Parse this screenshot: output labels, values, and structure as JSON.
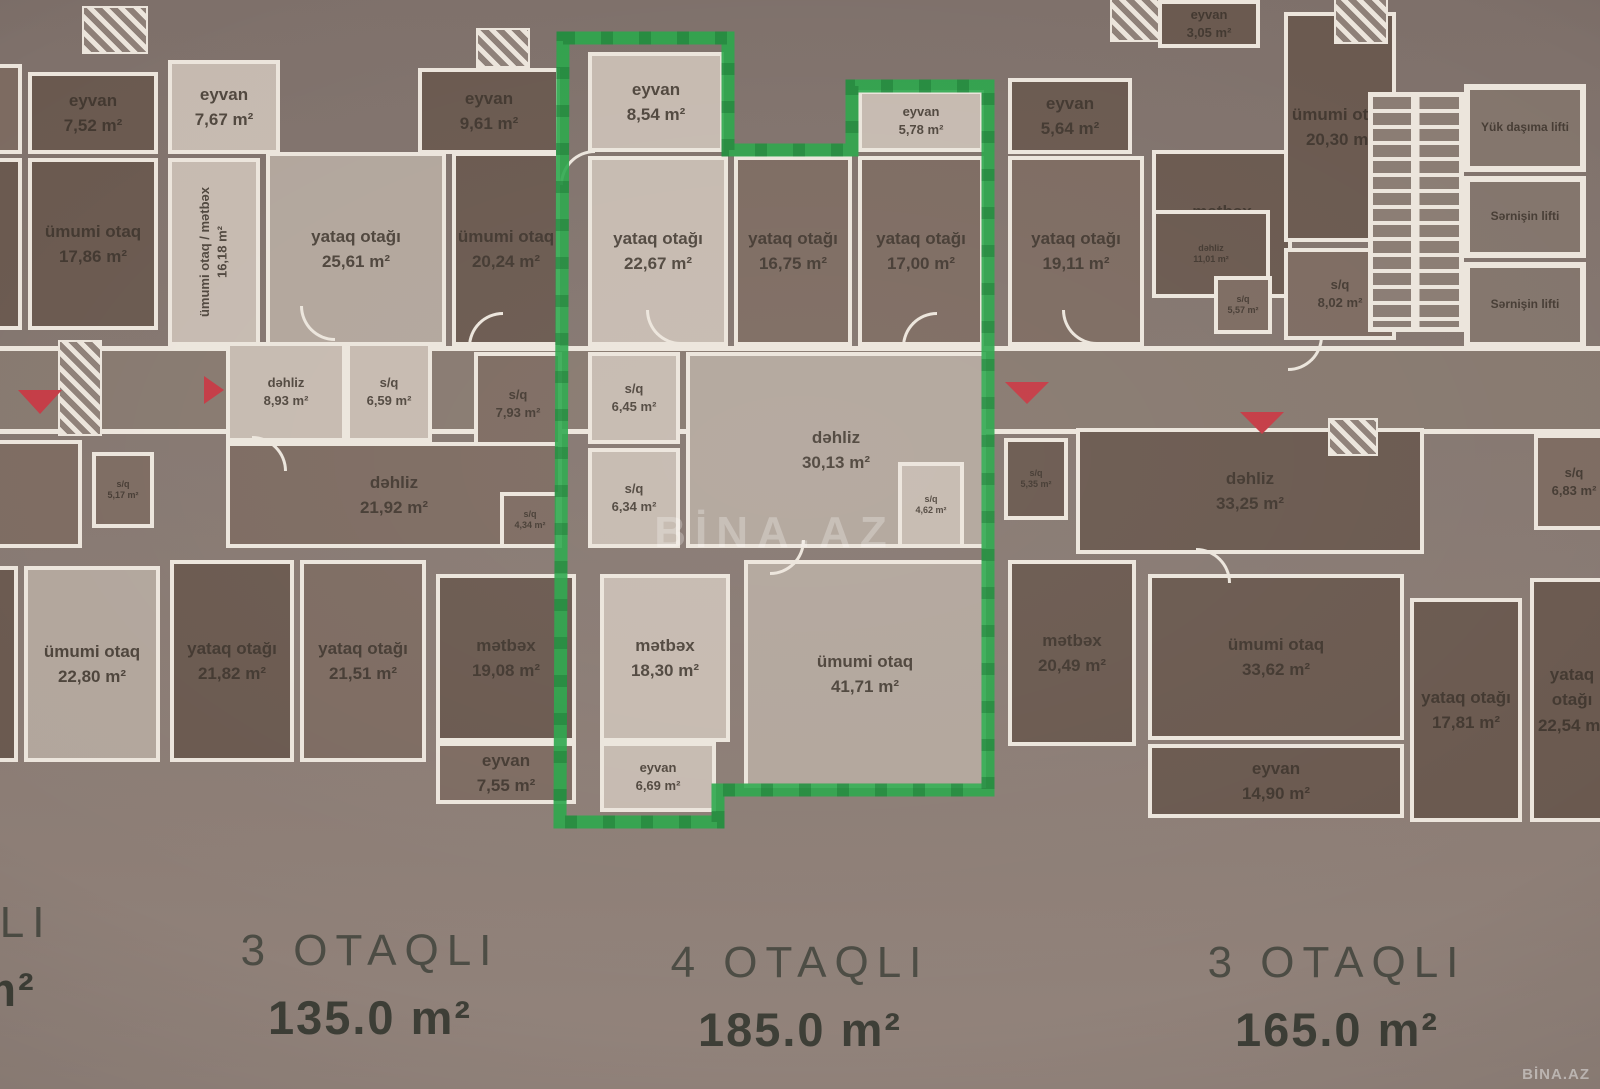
{
  "plan": {
    "rooms": [
      {
        "label": "",
        "area": "",
        "x": -36,
        "y": 64,
        "w": 58,
        "h": 90,
        "tone": "med"
      },
      {
        "label": "",
        "area": "",
        "x": -36,
        "y": 158,
        "w": 58,
        "h": 172,
        "tone": "dark"
      },
      {
        "label": "",
        "area": "",
        "x": -36,
        "y": 440,
        "w": 118,
        "h": 108,
        "tone": "med"
      },
      {
        "label": "",
        "area": "",
        "x": -36,
        "y": 566,
        "w": 54,
        "h": 196,
        "tone": "dark"
      },
      {
        "label": "eyvan",
        "area": "7,52 m²",
        "x": 28,
        "y": 72,
        "w": 130,
        "h": 82,
        "tone": "dark"
      },
      {
        "label": "eyvan",
        "area": "7,67 m²",
        "x": 168,
        "y": 60,
        "w": 112,
        "h": 94,
        "tone": "light"
      },
      {
        "label": "eyvan",
        "area": "9,61 m²",
        "x": 418,
        "y": 68,
        "w": 142,
        "h": 86,
        "tone": "dark"
      },
      {
        "label": "eyvan",
        "area": "8,54 m²",
        "x": 588,
        "y": 52,
        "w": 136,
        "h": 100,
        "tone": "light"
      },
      {
        "label": "eyvan",
        "area": "5,78 m²",
        "x": 858,
        "y": 90,
        "w": 126,
        "h": 62,
        "tone": "light",
        "size": "small"
      },
      {
        "label": "eyvan",
        "area": "5,64 m²",
        "x": 1008,
        "y": 78,
        "w": 124,
        "h": 76,
        "tone": "dark"
      },
      {
        "label": "eyvan",
        "area": "3,05 m²",
        "x": 1158,
        "y": 0,
        "w": 102,
        "h": 48,
        "tone": "dark",
        "size": "small"
      },
      {
        "label": "ümumi otaq",
        "area": "17,86 m²",
        "x": 28,
        "y": 158,
        "w": 130,
        "h": 172,
        "tone": "dark"
      },
      {
        "label": "ümumi otaq / mətbəx",
        "area": "16,18 m²",
        "x": 168,
        "y": 158,
        "w": 92,
        "h": 188,
        "tone": "light",
        "rot": true,
        "size": "small"
      },
      {
        "label": "yataq otağı",
        "area": "25,61 m²",
        "x": 266,
        "y": 152,
        "w": 180,
        "h": 194,
        "tone": "lighter"
      },
      {
        "label": "ümumi otaq",
        "area": "20,24 m²",
        "x": 452,
        "y": 152,
        "w": 108,
        "h": 194,
        "tone": "dark"
      },
      {
        "label": "yataq otağı",
        "area": "22,67 m²",
        "x": 588,
        "y": 156,
        "w": 140,
        "h": 190,
        "tone": "light"
      },
      {
        "label": "yataq otağı",
        "area": "16,75 m²",
        "x": 734,
        "y": 156,
        "w": 118,
        "h": 190,
        "tone": "med"
      },
      {
        "label": "yataq otağı",
        "area": "17,00 m²",
        "x": 858,
        "y": 156,
        "w": 126,
        "h": 190,
        "tone": "med"
      },
      {
        "label": "yataq otağı",
        "area": "19,11 m²",
        "x": 1008,
        "y": 156,
        "w": 136,
        "h": 190,
        "tone": "med"
      },
      {
        "label": "mətbəx",
        "area": "13,05 m²",
        "x": 1152,
        "y": 150,
        "w": 140,
        "h": 148,
        "tone": "dark"
      },
      {
        "label": "ümumi otaq",
        "area": "20,30 m²",
        "x": 1284,
        "y": 12,
        "w": 112,
        "h": 230,
        "tone": "dark"
      },
      {
        "label": "dəhliz",
        "area": "11,01 m²",
        "x": 1152,
        "y": 210,
        "w": 118,
        "h": 88,
        "tone": "dark",
        "size": "tiny"
      },
      {
        "label": "s/q",
        "area": "5,57 m²",
        "x": 1214,
        "y": 276,
        "w": 58,
        "h": 58,
        "tone": "med",
        "size": "tiny"
      },
      {
        "label": "s/q",
        "area": "8,02 m²",
        "x": 1284,
        "y": 248,
        "w": 112,
        "h": 92,
        "tone": "med",
        "size": "small"
      },
      {
        "label": "dəhliz",
        "area": "8,93 m²",
        "x": 226,
        "y": 342,
        "w": 120,
        "h": 100,
        "tone": "light",
        "size": "small"
      },
      {
        "label": "s/q",
        "area": "6,59 m²",
        "x": 346,
        "y": 342,
        "w": 86,
        "h": 100,
        "tone": "light",
        "size": "small"
      },
      {
        "label": "s/q",
        "area": "7,93 m²",
        "x": 474,
        "y": 352,
        "w": 88,
        "h": 104,
        "tone": "med",
        "size": "small"
      },
      {
        "label": "s/q",
        "area": "5,17 m²",
        "x": 92,
        "y": 452,
        "w": 62,
        "h": 76,
        "tone": "med",
        "size": "tiny"
      },
      {
        "label": "dəhliz",
        "area": "21,92 m²",
        "x": 226,
        "y": 442,
        "w": 336,
        "h": 106,
        "tone": "med"
      },
      {
        "label": "s/q",
        "area": "4,34 m²",
        "x": 500,
        "y": 492,
        "w": 60,
        "h": 56,
        "tone": "med",
        "size": "tiny"
      },
      {
        "label": "s/q",
        "area": "6,45 m²",
        "x": 588,
        "y": 352,
        "w": 92,
        "h": 92,
        "tone": "light",
        "size": "small"
      },
      {
        "label": "s/q",
        "area": "6,34 m²",
        "x": 588,
        "y": 448,
        "w": 92,
        "h": 100,
        "tone": "light",
        "size": "small"
      },
      {
        "label": "dəhliz",
        "area": "30,13 m²",
        "x": 686,
        "y": 352,
        "w": 300,
        "h": 196,
        "tone": "lighter"
      },
      {
        "label": "s/q",
        "area": "4,62 m²",
        "x": 898,
        "y": 462,
        "w": 66,
        "h": 86,
        "tone": "light",
        "size": "tiny"
      },
      {
        "label": "s/q",
        "area": "5,35 m²",
        "x": 1004,
        "y": 438,
        "w": 64,
        "h": 82,
        "tone": "dark",
        "size": "tiny"
      },
      {
        "label": "dəhliz",
        "area": "33,25 m²",
        "x": 1076,
        "y": 428,
        "w": 348,
        "h": 126,
        "tone": "dark"
      },
      {
        "label": "s/q",
        "area": "6,83 m²",
        "x": 1534,
        "y": 434,
        "w": 80,
        "h": 96,
        "tone": "med",
        "size": "small"
      },
      {
        "label": "ümumi otaq",
        "area": "22,80 m²",
        "x": 24,
        "y": 566,
        "w": 136,
        "h": 196,
        "tone": "lighter"
      },
      {
        "label": "yataq otağı",
        "area": "21,82 m²",
        "x": 170,
        "y": 560,
        "w": 124,
        "h": 202,
        "tone": "dark"
      },
      {
        "label": "yataq otağı",
        "area": "21,51 m²",
        "x": 300,
        "y": 560,
        "w": 126,
        "h": 202,
        "tone": "med"
      },
      {
        "label": "mətbəx",
        "area": "19,08 m²",
        "x": 436,
        "y": 574,
        "w": 140,
        "h": 168,
        "tone": "dark"
      },
      {
        "label": "mətbəx",
        "area": "18,30 m²",
        "x": 600,
        "y": 574,
        "w": 130,
        "h": 168,
        "tone": "light"
      },
      {
        "label": "ümumi otaq",
        "area": "41,71 m²",
        "x": 744,
        "y": 560,
        "w": 242,
        "h": 228,
        "tone": "lighter"
      },
      {
        "label": "mətbəx",
        "area": "20,49 m²",
        "x": 1008,
        "y": 560,
        "w": 128,
        "h": 186,
        "tone": "dark"
      },
      {
        "label": "ümumi otaq",
        "area": "33,62 m²",
        "x": 1148,
        "y": 574,
        "w": 256,
        "h": 166,
        "tone": "dark"
      },
      {
        "label": "yataq otağı",
        "area": "17,81 m²",
        "x": 1410,
        "y": 598,
        "w": 112,
        "h": 224,
        "tone": "dark"
      },
      {
        "label": "yataq otağı",
        "area": "22,54 m²",
        "x": 1530,
        "y": 578,
        "w": 84,
        "h": 244,
        "tone": "dark"
      },
      {
        "label": "eyvan",
        "area": "7,55 m²",
        "x": 436,
        "y": 742,
        "w": 140,
        "h": 62,
        "tone": "med"
      },
      {
        "label": "eyvan",
        "area": "6,69 m²",
        "x": 600,
        "y": 742,
        "w": 116,
        "h": 70,
        "tone": "light",
        "size": "small"
      },
      {
        "label": "eyvan",
        "area": "14,90 m²",
        "x": 1148,
        "y": 744,
        "w": 256,
        "h": 74,
        "tone": "dark"
      },
      {
        "label": "Yük daşıma lifti",
        "area": "",
        "x": 1464,
        "y": 84,
        "w": 122,
        "h": 88,
        "tone": "lift"
      },
      {
        "label": "Sərnişin lifti",
        "area": "",
        "x": 1464,
        "y": 176,
        "w": 122,
        "h": 82,
        "tone": "lift"
      },
      {
        "label": "Sərnişin lifti",
        "area": "",
        "x": 1464,
        "y": 262,
        "w": 122,
        "h": 86,
        "tone": "lift"
      }
    ]
  },
  "highlight": {
    "color": "#2aa64a"
  },
  "footer": {
    "cut_rooms": "QLI",
    "cut_area": "m²",
    "units": [
      {
        "rooms": "3 OTAQLI",
        "area": "135.0 m²"
      },
      {
        "rooms": "4 OTAQLI",
        "area": "185.0 m²"
      },
      {
        "rooms": "3 OTAQLI",
        "area": "165.0 m²"
      }
    ]
  },
  "watermarks": {
    "center": "BİNA.AZ",
    "corner": "BİNA.AZ"
  }
}
